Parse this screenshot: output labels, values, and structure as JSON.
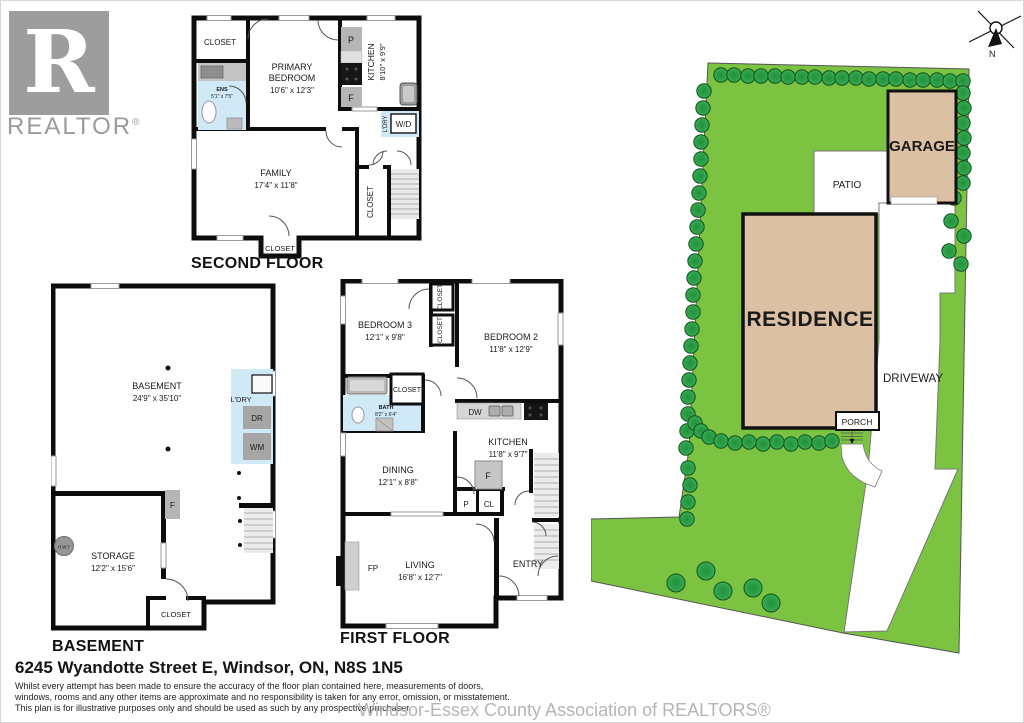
{
  "branding": {
    "logo_r": "R",
    "logo_text": "REALTOR",
    "reg": "®",
    "watermark": "Windsor-Essex County Association of REALTORS®"
  },
  "footer": {
    "address": "6245 Wyandotte Street E, Windsor, ON, N8S 1N5",
    "disclaimer1": "Whilst every attempt has been made to ensure the accuracy of the floor plan contained here, measurements of doors,",
    "disclaimer2": "windows, rooms and any other items are approximate and no responsibility is taken for any error, omission, or misstatement.",
    "disclaimer3": "This plan is for illustrative purposes only and should be used as such by any prospective purchaser."
  },
  "compass": {
    "n": "N"
  },
  "site": {
    "labels": {
      "residence": "RESIDENCE",
      "garage": "GARAGE",
      "patio": "PATIO",
      "driveway": "DRIVEWAY",
      "porch": "PORCH"
    },
    "colors": {
      "lawn": "#7cc342",
      "lot_outline": "#555555",
      "tree_fill": "#2fa24b",
      "tree_stroke": "#14521f",
      "building": "#dcc0a3",
      "wall": "#111111",
      "wet_area": "#cfe9f7",
      "appliance": "#b5b5b5"
    },
    "trees": [
      [
        130,
        34
      ],
      [
        143,
        34
      ],
      [
        157,
        35
      ],
      [
        170,
        35
      ],
      [
        184,
        35
      ],
      [
        197,
        36
      ],
      [
        211,
        36
      ],
      [
        224,
        36
      ],
      [
        238,
        37
      ],
      [
        251,
        37
      ],
      [
        265,
        37
      ],
      [
        278,
        38
      ],
      [
        292,
        38
      ],
      [
        305,
        38
      ],
      [
        319,
        39
      ],
      [
        332,
        39
      ],
      [
        346,
        39
      ],
      [
        359,
        40
      ],
      [
        372,
        40
      ],
      [
        113,
        50
      ],
      [
        112,
        67
      ],
      [
        111,
        84
      ],
      [
        110,
        101
      ],
      [
        110,
        118
      ],
      [
        109,
        135
      ],
      [
        108,
        152
      ],
      [
        107,
        169
      ],
      [
        106,
        186
      ],
      [
        105,
        203
      ],
      [
        104,
        220
      ],
      [
        103,
        237
      ],
      [
        102,
        254
      ],
      [
        102,
        271
      ],
      [
        101,
        288
      ],
      [
        100,
        305
      ],
      [
        99,
        322
      ],
      [
        98,
        339
      ],
      [
        97,
        356
      ],
      [
        97,
        373
      ],
      [
        96,
        390
      ],
      [
        95,
        407
      ],
      [
        97,
        427
      ],
      [
        99,
        444
      ],
      [
        97,
        461
      ],
      [
        96,
        478
      ],
      [
        104,
        382
      ],
      [
        110,
        390
      ],
      [
        118,
        396
      ],
      [
        130,
        400
      ],
      [
        144,
        402
      ],
      [
        158,
        401
      ],
      [
        172,
        403
      ],
      [
        186,
        401
      ],
      [
        200,
        403
      ],
      [
        214,
        401
      ],
      [
        228,
        402
      ],
      [
        241,
        400
      ],
      [
        372,
        52
      ],
      [
        373,
        67
      ],
      [
        372,
        82
      ],
      [
        373,
        97
      ],
      [
        372,
        112
      ],
      [
        373,
        127
      ],
      [
        372,
        142
      ],
      [
        363,
        157
      ],
      [
        360,
        180
      ],
      [
        373,
        195
      ],
      [
        358,
        210
      ],
      [
        370,
        223
      ],
      [
        115,
        530,
        9
      ],
      [
        85,
        542,
        9
      ],
      [
        132,
        550,
        9
      ],
      [
        162,
        547,
        9
      ],
      [
        180,
        562,
        9
      ]
    ]
  },
  "second_floor": {
    "title": "SECOND FLOOR",
    "closet_tl": "CLOSET",
    "primary_l1": "PRIMARY",
    "primary_l2": "BEDROOM",
    "primary_dims": "10'6\" x 12'3\"",
    "ens": "ENS",
    "ens_dims": "5'1\" x 7'5\"",
    "kitchen": "KITCHEN",
    "kitchen_dims": "8'10\" x 9'9\"",
    "pantry": "P",
    "fridge": "F",
    "laundry": "L'DRY",
    "washer_dryer": "W/D",
    "family": "FAMILY",
    "family_dims": "17'4\" x 11'8\"",
    "closet_right": "CLOSET",
    "closet_bottom": "CLOSET"
  },
  "first_floor": {
    "title": "FIRST FLOOR",
    "bedroom3": "BEDROOM 3",
    "bedroom3_dims": "12'1\" x 9'8\"",
    "bedroom2": "BEDROOM 2",
    "bedroom2_dims": "11'8\" x 12'9\"",
    "closet_v1": "CLOSET",
    "closet_v2": "CLOSET",
    "closet_h": "CLOSET",
    "bath": "BATH",
    "bath_dims": "8'2\" x 6'4\"",
    "dining": "DINING",
    "dining_dims": "12'1\" x 8'8\"",
    "kitchen": "KITCHEN",
    "kitchen_dims": "11'8\" x 9'7\"",
    "dishwasher": "DW",
    "fridge": "F",
    "pantry": "P",
    "closet_abbr": "CL",
    "living": "LIVING",
    "living_dims": "16'8\" x 12'7\"",
    "fireplace": "FP",
    "entry": "ENTRY"
  },
  "basement": {
    "title": "BASEMENT",
    "basement": "BASEMENT",
    "basement_dims": "24'9\" x 35'10\"",
    "laundry": "L'DRY",
    "dryer": "DR",
    "washer": "WM",
    "furnace": "F",
    "hwt": "H.W.T",
    "storage": "STORAGE",
    "storage_dims": "12'2\" x 15'6\"",
    "closet": "CLOSET"
  }
}
